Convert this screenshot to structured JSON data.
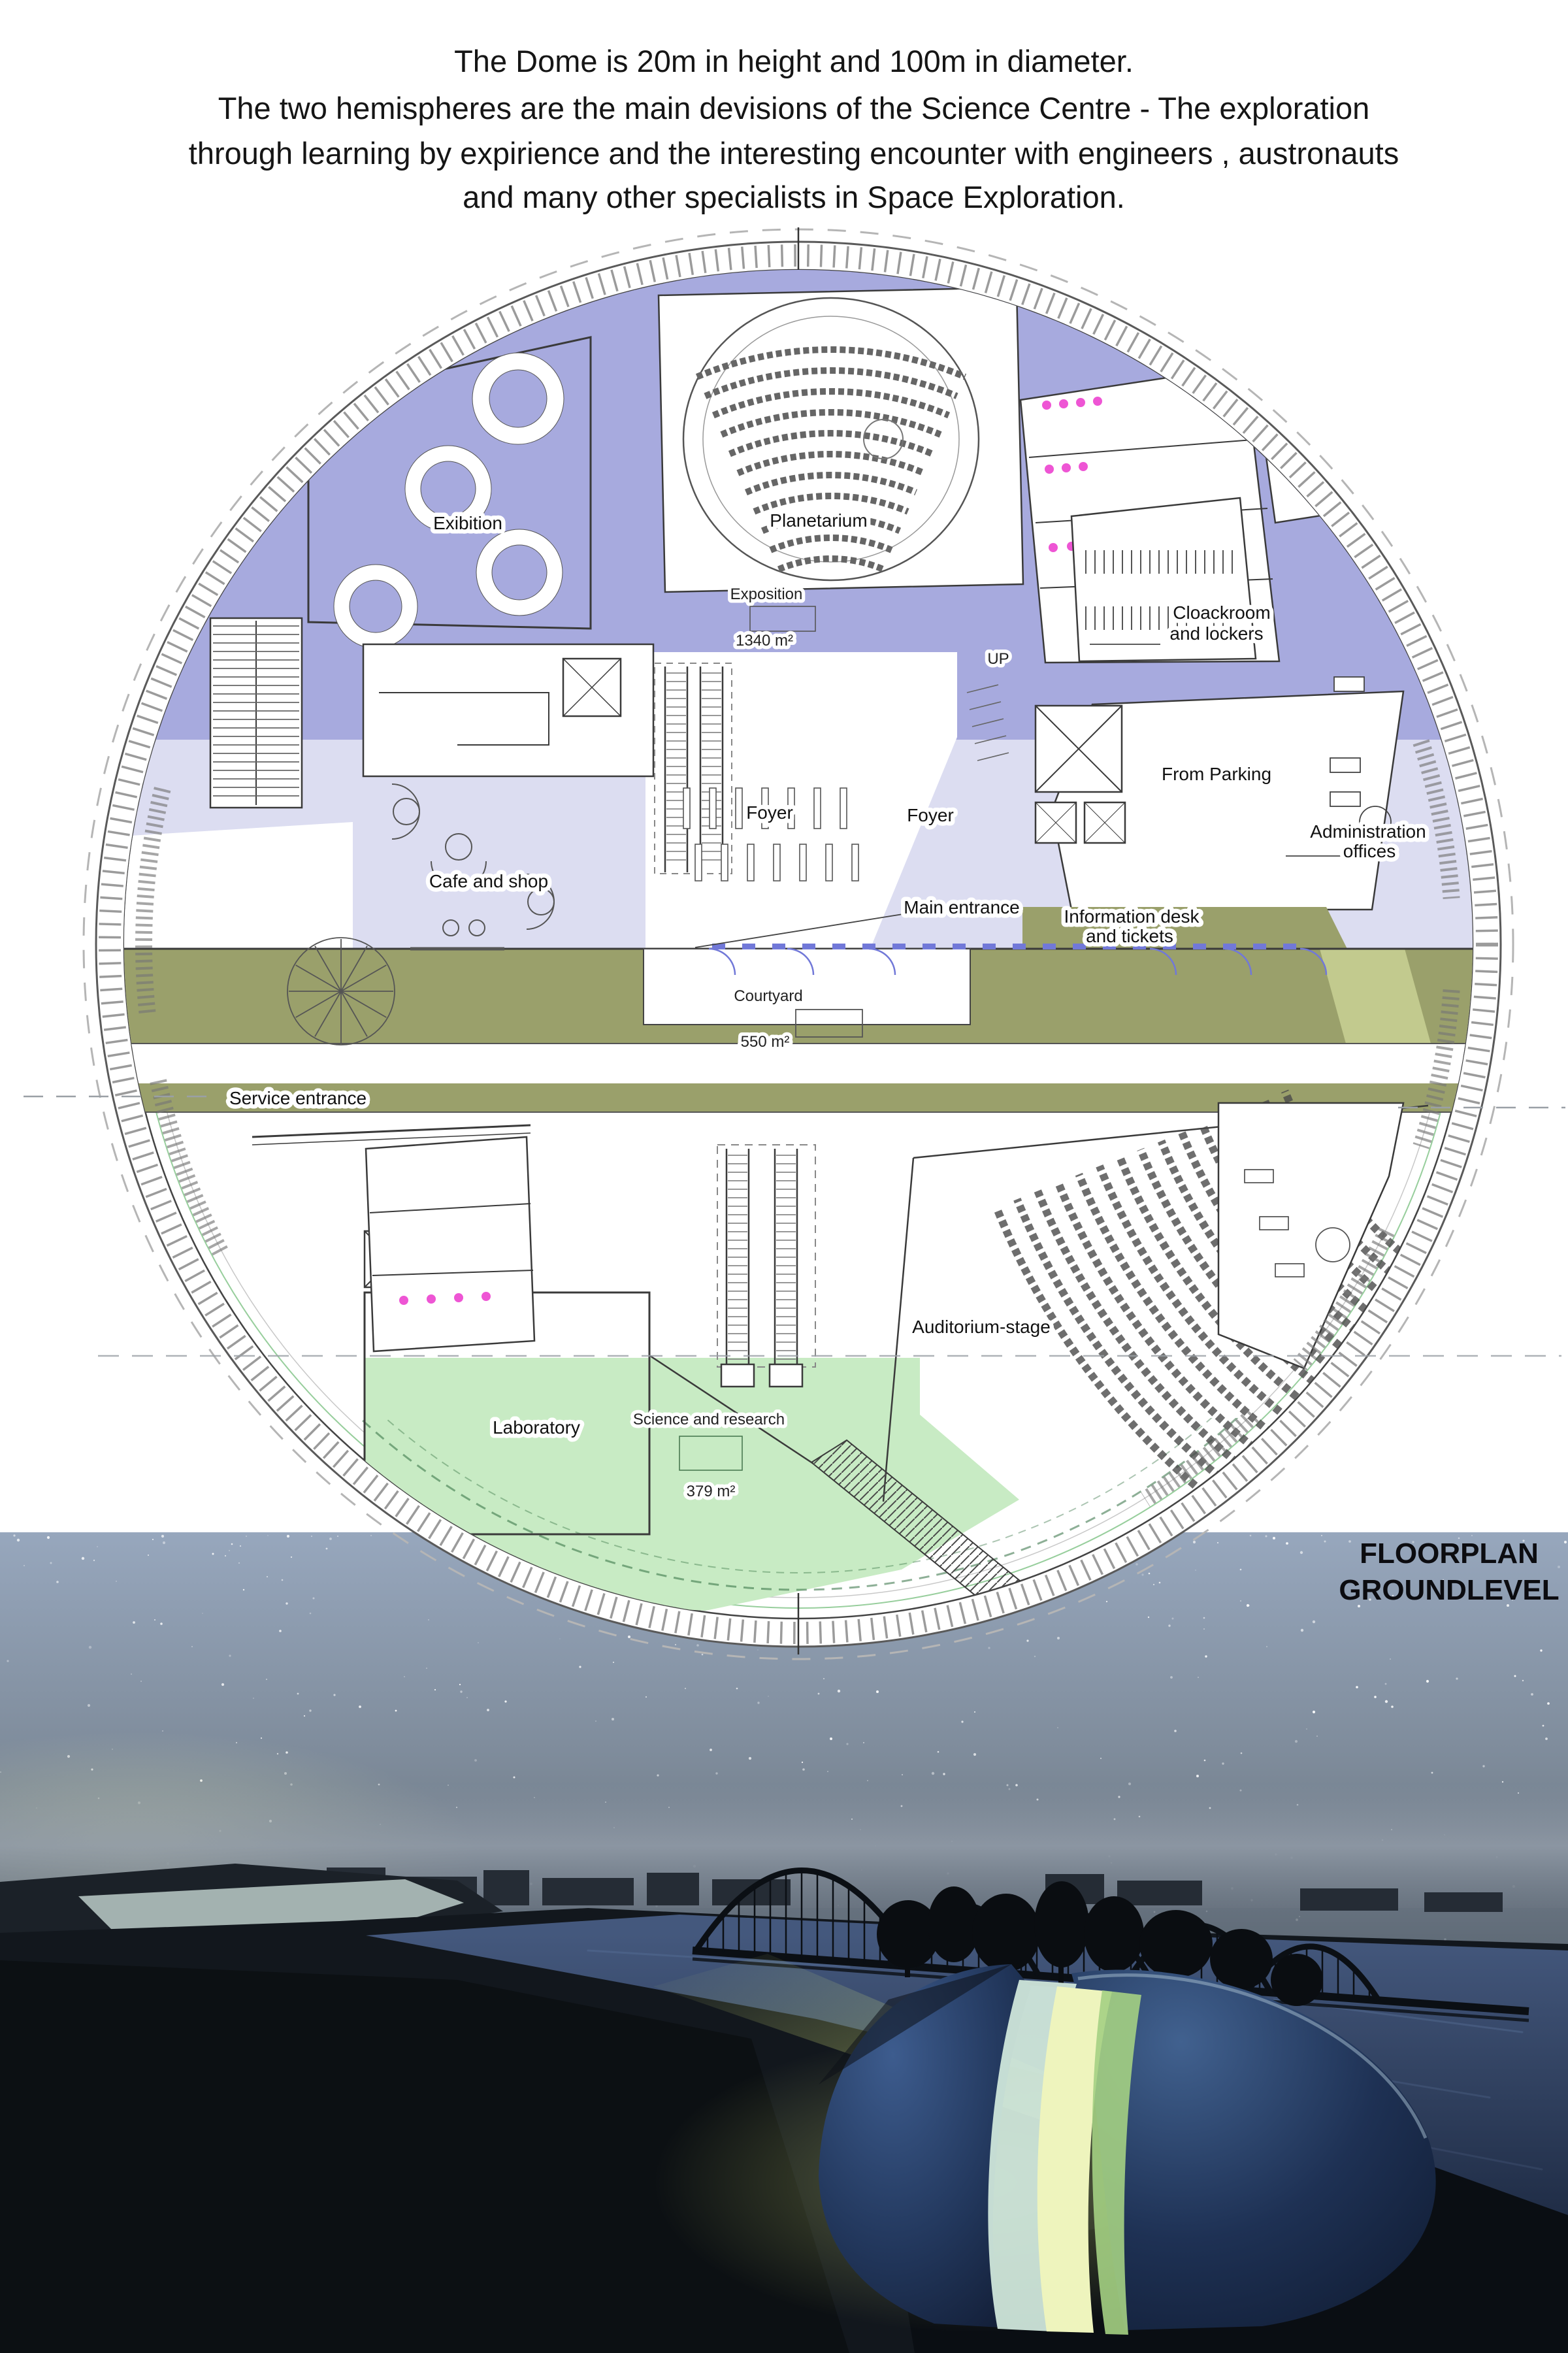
{
  "header": {
    "lines": [
      "The Dome is 20m in height and 100m in diameter.",
      "The two hemispheres are the main devisions of the Science Centre - The exploration",
      "through learning by expirience and the interesting encounter with engineers , austronauts",
      "and many other specialists in Space Exploration."
    ]
  },
  "plan": {
    "labels": {
      "exibition": "Exibition",
      "planetarium": "Planetarium",
      "exposition": "Exposition",
      "exposition_area": "1340 m²",
      "cloakroom_line1": "Cloackroom",
      "cloakroom_line2": "and lockers",
      "up": "UP",
      "from_parking": "From Parking",
      "admin_line1": "Administration",
      "admin_line2": "offices",
      "foyer_left": "Foyer",
      "foyer_center": "Foyer",
      "cafe_and_shop": "Cafe and shop",
      "main_entrance": "Main entrance",
      "info_desk_line1": "Information desk",
      "info_desk_line2": "and tickets",
      "courtyard": "Courtyard",
      "courtyard_area": "550 m²",
      "service_entrance": "Service entrance",
      "auditorium_stage": "Auditorium-stage",
      "laboratory": "Laboratory",
      "science_research": "Science and research",
      "science_area": "379 m²"
    },
    "colors": {
      "exposition_purple": "#a7aade",
      "foyer_lavender": "#dcddf1",
      "entrance_olive": "#9aa06b",
      "olive_light": "#c2ca8e",
      "science_green": "#c8ebc4",
      "fixture_pink": "#ee55d4",
      "ring_green_line": "#8cc991",
      "door_blue": "#7178d8"
    }
  },
  "render": {
    "caption_line1": "FLOORPLAN",
    "caption_line2": "GROUNDLEVEL",
    "colors": {
      "sky_top": "#97a7bd",
      "sky_low": "#5d6874",
      "water": "#2d4160",
      "lake": "#b2c2bf",
      "silhouette": "#0c1014",
      "dome_glass_hi": "#3d5c8e",
      "dome_glass_lo": "#16243f",
      "gap_bright": "#eef4bd",
      "gap_pale": "#cfe6da",
      "gap_green": "#a4d083"
    }
  }
}
